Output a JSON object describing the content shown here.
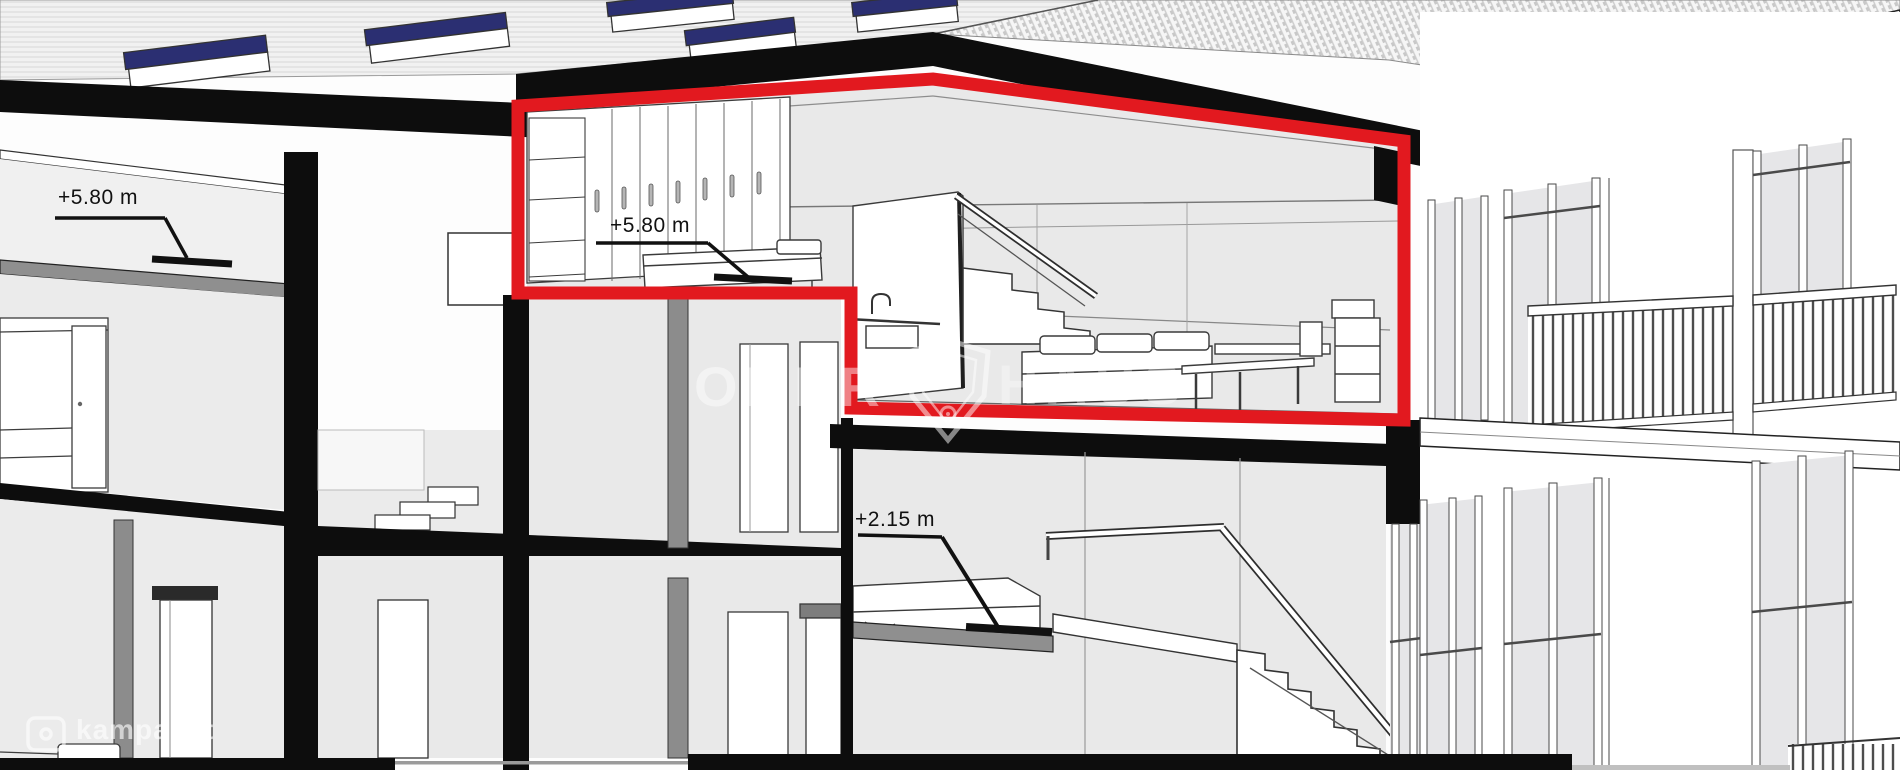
{
  "annotations": {
    "left_elevation": {
      "label": "+5.80 m"
    },
    "unit_elevation": {
      "label": "+5.80 m"
    },
    "lower_elevation": {
      "label": "+2.15 m"
    }
  },
  "watermarks": {
    "portal": "kampas.lt",
    "agency_left": "OBER",
    "agency_right": "HAUS"
  },
  "colors": {
    "highlight_red": "#e2191f",
    "structure_black": "#0d0d0d",
    "interior_gray": "#e9e9e9",
    "skylight_navy": "#2b2f72",
    "slab_gray": "#8f8f8f"
  }
}
